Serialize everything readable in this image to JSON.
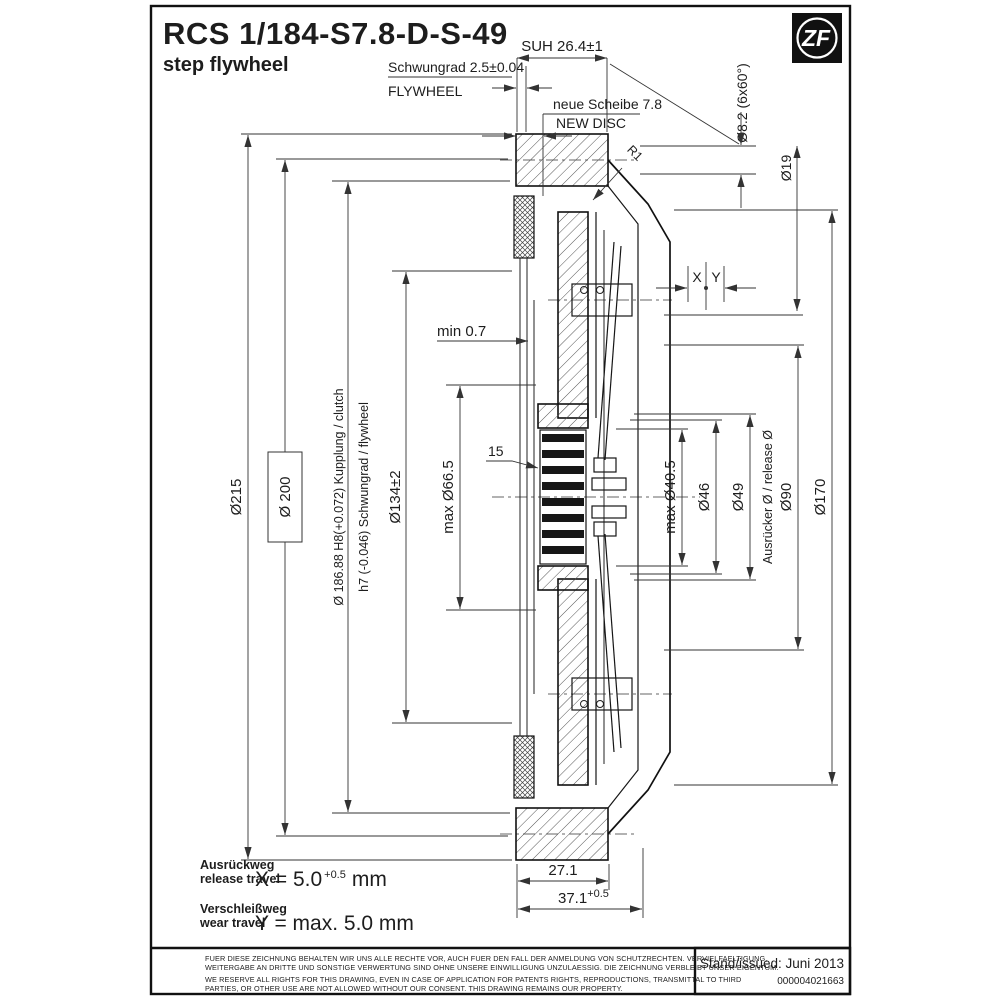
{
  "colors": {
    "line": "#1d1d1d",
    "background": "#ffffff",
    "logo_bg": "#111111"
  },
  "header": {
    "drawing_code": "RCS 1/184-S7.8-D-S-49",
    "drawing_type": "step flywheel"
  },
  "logo": {
    "text": "ZF"
  },
  "dimensions": {
    "suh": "SUH 26.4±1",
    "flywheel_step_de": "Schwungrad 2.5±0.04",
    "flywheel_step_en": "FLYWHEEL",
    "new_disc_de": "neue Scheibe 7.8",
    "new_disc_en": "NEW DISC",
    "bolt_holes": "Ø8.2 (6x60°)",
    "pilot_dia": "Ø19",
    "fillet_radius": "R1",
    "min_clearance": "min 0.7",
    "spline_length": "15",
    "travel_x": "X",
    "travel_y": "Y",
    "outer_dia": "Ø215",
    "register_dia": "Ø 200",
    "fit_dia_line1": "Ø 186.88 H8(+0.072) Kupplung / clutch",
    "fit_dia_line2": "h7 (-0.046) Schwungrad / flywheel",
    "disc_dia": "Ø134±2",
    "hub_max_dia": "max Ø66.5",
    "finger_max_dia": "max Ø40.5",
    "bearing_contact_dia": "Ø46",
    "release_dia_value": "Ø49",
    "release_dia_label": "Ausrücker Ø / release Ø",
    "bolt_circle_dia": "Ø90",
    "cover_bolt_dia": "Ø170",
    "width_disc": "27.1",
    "width_total_base": "37.1",
    "width_total_tol": "+0.5"
  },
  "travel_legend": {
    "release_de": "Ausrückweg",
    "release_en": "release travel",
    "x_prefix": "X = 5.0",
    "x_tol": "+0.5",
    "x_unit": "mm",
    "wear_de": "Verschleißweg",
    "wear_en": "wear travel",
    "y_text": "Y = max. 5.0 mm"
  },
  "footer": {
    "disclaimer_de_1": "FUER DIESE ZEICHNUNG BEHALTEN WIR UNS ALLE RECHTE VOR, AUCH FUER DEN FALL DER ANMELDUNG VON SCHUTZRECHTEN. VERVIELFAELTIGUNG,",
    "disclaimer_de_2": "WEITERGABE AN DRITTE UND SONSTIGE VERWERTUNG SIND OHNE UNSERE EINWILLIGUNG UNZULAESSIG. DIE ZEICHNUNG VERBLEIBT UNSER EIGENTUM.",
    "disclaimer_en_1": "WE RESERVE ALL RIGHTS FOR THIS DRAWING, EVEN IN CASE OF APPLICATION FOR PATENTS RIGHTS, REPRODUCTIONS, TRANSMITTAL TO THIRD",
    "disclaimer_en_2": "PARTIES, OR OTHER USE ARE NOT ALLOWED WITHOUT OUR CONSENT. THIS DRAWING REMAINS OUR PROPERTY.",
    "issued": "Stand/issued: Juni 2013",
    "document_number": "000004021663"
  }
}
